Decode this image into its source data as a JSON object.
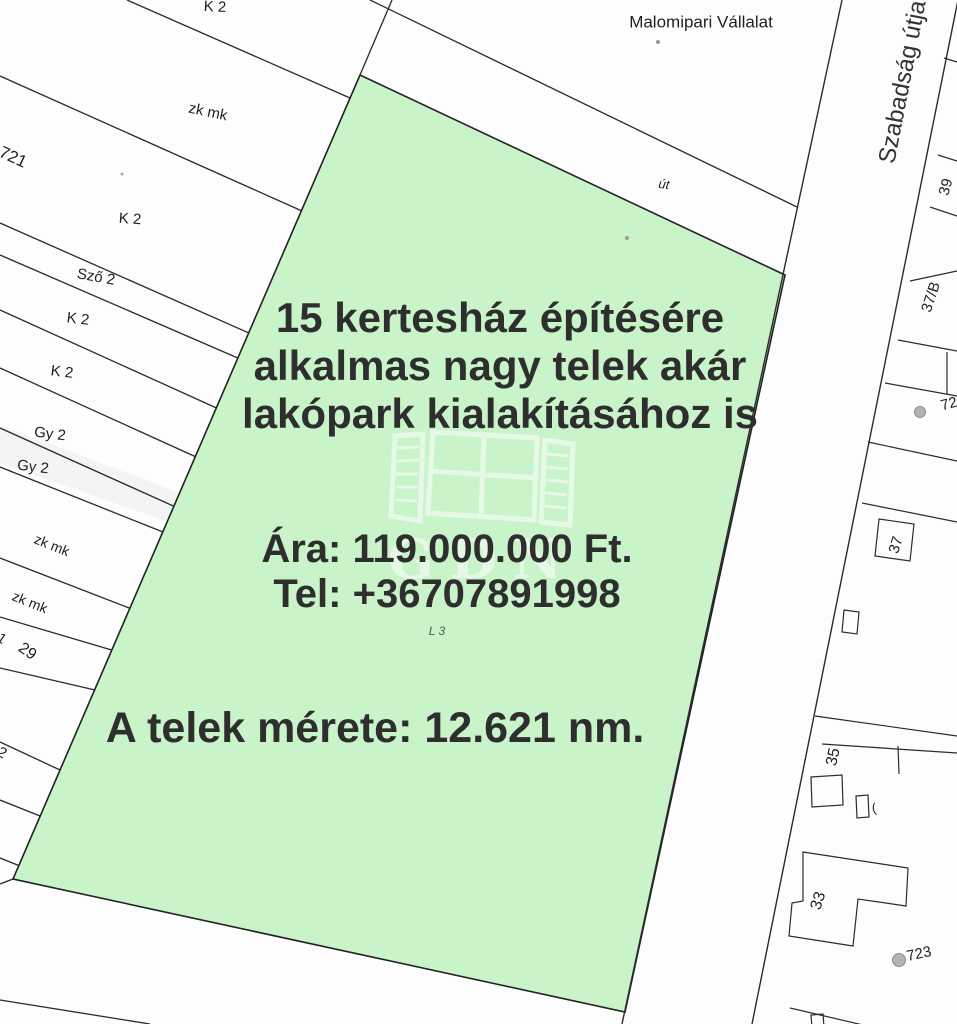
{
  "listing": {
    "title_lines": [
      "15 kertesház építésére",
      "alkalmas nagy telek akár",
      "lakópark kialakításához is"
    ],
    "price_line": "Ára: 119.000.000 Ft.",
    "phone_line": "Tel: +36707891998",
    "size_line": "A telek mérete: 12.621 nm.",
    "watermark_text": "GDN"
  },
  "map": {
    "highlight_fill": "#c9f3c9",
    "line_color": "#2b2b2b",
    "labels": [
      {
        "name": "malomipari-vallalat",
        "text": "Malomipari Vállalat",
        "x": 701,
        "y": 22,
        "rot": 0,
        "size": 17
      },
      {
        "name": "szabadsag-utja",
        "text": "Szabadság útja",
        "x": 903,
        "y": 82,
        "rot": -79,
        "size": 24,
        "color": "#333333"
      },
      {
        "name": "ut",
        "text": "út",
        "x": 664,
        "y": 184,
        "rot": 8,
        "size": 13,
        "italic": true
      },
      {
        "name": "k2-top",
        "text": "K 2",
        "x": 215,
        "y": 7,
        "rot": 3,
        "size": 15
      },
      {
        "name": "zkmk-a",
        "text": "zk mk",
        "x": 208,
        "y": 112,
        "rot": 12,
        "size": 15
      },
      {
        "name": "parcel-721",
        "text": "721",
        "x": 13,
        "y": 157,
        "rot": 25,
        "size": 17
      },
      {
        "name": "k2-b",
        "text": "K 2",
        "x": 130,
        "y": 219,
        "rot": 4,
        "size": 15
      },
      {
        "name": "szo2",
        "text": "Sző 2",
        "x": 96,
        "y": 277,
        "rot": 10,
        "size": 15
      },
      {
        "name": "k2-c",
        "text": "K 2",
        "x": 78,
        "y": 319,
        "rot": 7,
        "size": 15
      },
      {
        "name": "k2-d",
        "text": "K 2",
        "x": 62,
        "y": 372,
        "rot": 7,
        "size": 15
      },
      {
        "name": "gy2-a",
        "text": "Gy 2",
        "x": 50,
        "y": 434,
        "rot": 7,
        "size": 15
      },
      {
        "name": "gy2-b",
        "text": "Gy 2",
        "x": 33,
        "y": 467,
        "rot": 7,
        "size": 15
      },
      {
        "name": "zkmk-b",
        "text": "zk mk",
        "x": 52,
        "y": 545,
        "rot": 22,
        "size": 14
      },
      {
        "name": "zkmk-c",
        "text": "zk mk",
        "x": 30,
        "y": 602,
        "rot": 22,
        "size": 14
      },
      {
        "name": "partial-1",
        "text": "1",
        "x": 2,
        "y": 638,
        "rot": 35,
        "size": 14
      },
      {
        "name": "parcel-29",
        "text": "29",
        "x": 27,
        "y": 652,
        "rot": 35,
        "size": 16
      },
      {
        "name": "partial-2",
        "text": "2",
        "x": 2,
        "y": 753,
        "rot": 30,
        "size": 15
      },
      {
        "name": "l3",
        "text": "L 3",
        "x": 437,
        "y": 631,
        "rot": 0,
        "size": 12,
        "italic": true,
        "color": "#555555"
      },
      {
        "name": "parcel-39",
        "text": "39",
        "x": 946,
        "y": 187,
        "rot": -75,
        "size": 15
      },
      {
        "name": "parcel-37b",
        "text": "37/B",
        "x": 931,
        "y": 297,
        "rot": -72,
        "size": 15
      },
      {
        "name": "parcel-72",
        "text": "72",
        "x": 949,
        "y": 404,
        "rot": -15,
        "size": 15
      },
      {
        "name": "parcel-37",
        "text": "37",
        "x": 896,
        "y": 545,
        "rot": -72,
        "size": 15
      },
      {
        "name": "parcel-35",
        "text": "35",
        "x": 834,
        "y": 757,
        "rot": -78,
        "size": 16
      },
      {
        "name": "parcel-33",
        "text": "33",
        "x": 819,
        "y": 901,
        "rot": -72,
        "size": 16
      },
      {
        "name": "parcel-723",
        "text": "723",
        "x": 919,
        "y": 954,
        "rot": -12,
        "size": 15
      },
      {
        "name": "paren-mark",
        "text": "(",
        "x": 874,
        "y": 808,
        "rot": -10,
        "size": 13
      }
    ]
  }
}
